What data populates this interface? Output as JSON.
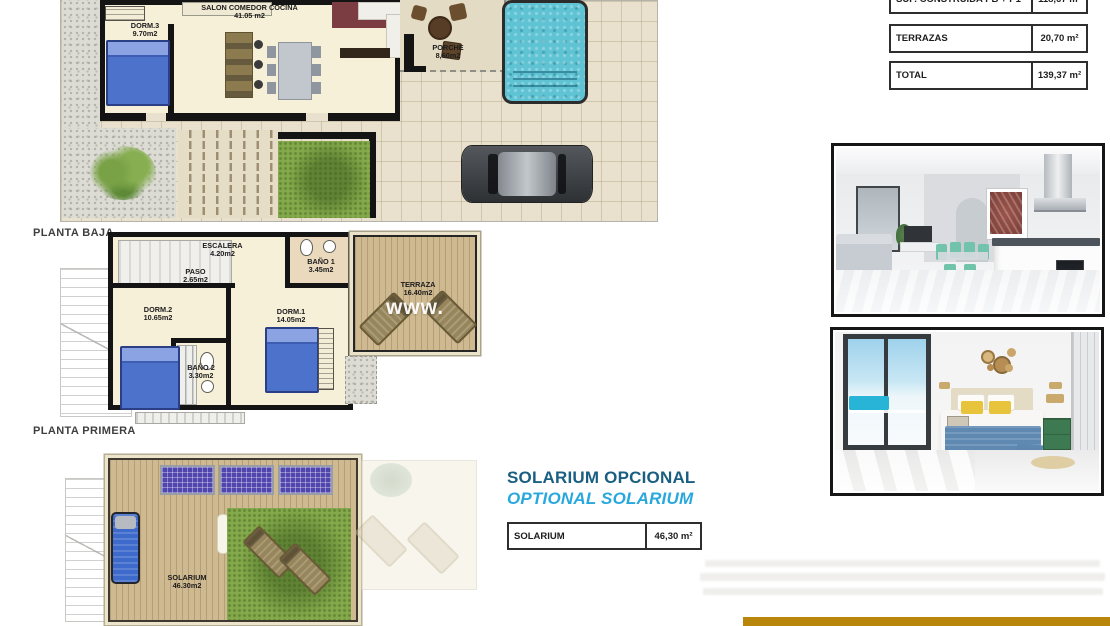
{
  "summary_table": {
    "rows": [
      {
        "label": "SUP. CONSTRUIDA PB + P1",
        "value": "118,67 m²"
      },
      {
        "label": "TERRAZAS",
        "value": "20,70 m²"
      },
      {
        "label": "TOTAL",
        "value": "139,37 m²"
      }
    ]
  },
  "plans": {
    "planta_baja": {
      "title": "PLANTA BAJA",
      "rooms": {
        "dorm3": {
          "name": "DORM.3",
          "area": "9.70m2"
        },
        "salon": {
          "name": "SALON COMEDOR COCINA",
          "area": "41.05 m2"
        },
        "porche": {
          "name": "PORCHE",
          "area": "8,60m2"
        }
      }
    },
    "planta_primera": {
      "title": "PLANTA PRIMERA",
      "watermark": "www.",
      "rooms": {
        "escalera": {
          "name": "ESCALERA",
          "area": "4.20m2"
        },
        "paso": {
          "name": "PASO",
          "area": "2.65m2"
        },
        "bano1": {
          "name": "BAÑO 1",
          "area": "3.45m2"
        },
        "dorm2": {
          "name": "DORM.2",
          "area": "10.65m2"
        },
        "dorm1": {
          "name": "DORM.1",
          "area": "14.05m2"
        },
        "bano2": {
          "name": "BAÑO 2",
          "area": "3.30m2"
        },
        "terraza": {
          "name": "TERRAZA",
          "area": "16.40m2"
        }
      }
    },
    "solarium_plan": {
      "rooms": {
        "solarium": {
          "name": "SOLARIUM",
          "area": "46.30m2"
        }
      }
    }
  },
  "solarium_section": {
    "title_es": "SOLARIUM OPCIONAL",
    "title_en": "OPTIONAL SOLARIUM",
    "table_row": {
      "label": "SOLARIUM",
      "value": "46,30 m²"
    }
  },
  "photos": {
    "photo1": "interior-living-kitchen",
    "photo2": "interior-bedroom"
  },
  "colors": {
    "heading_es": "#1a5f82",
    "heading_en": "#29a8dd",
    "footer_bar": "#b8860b",
    "pool": "#5fc3d4",
    "plan_floor": "#f7f0d9",
    "grass": "#85aa4c",
    "bed_blue": "#4d72cc",
    "solar_panel": "#5146ad"
  }
}
